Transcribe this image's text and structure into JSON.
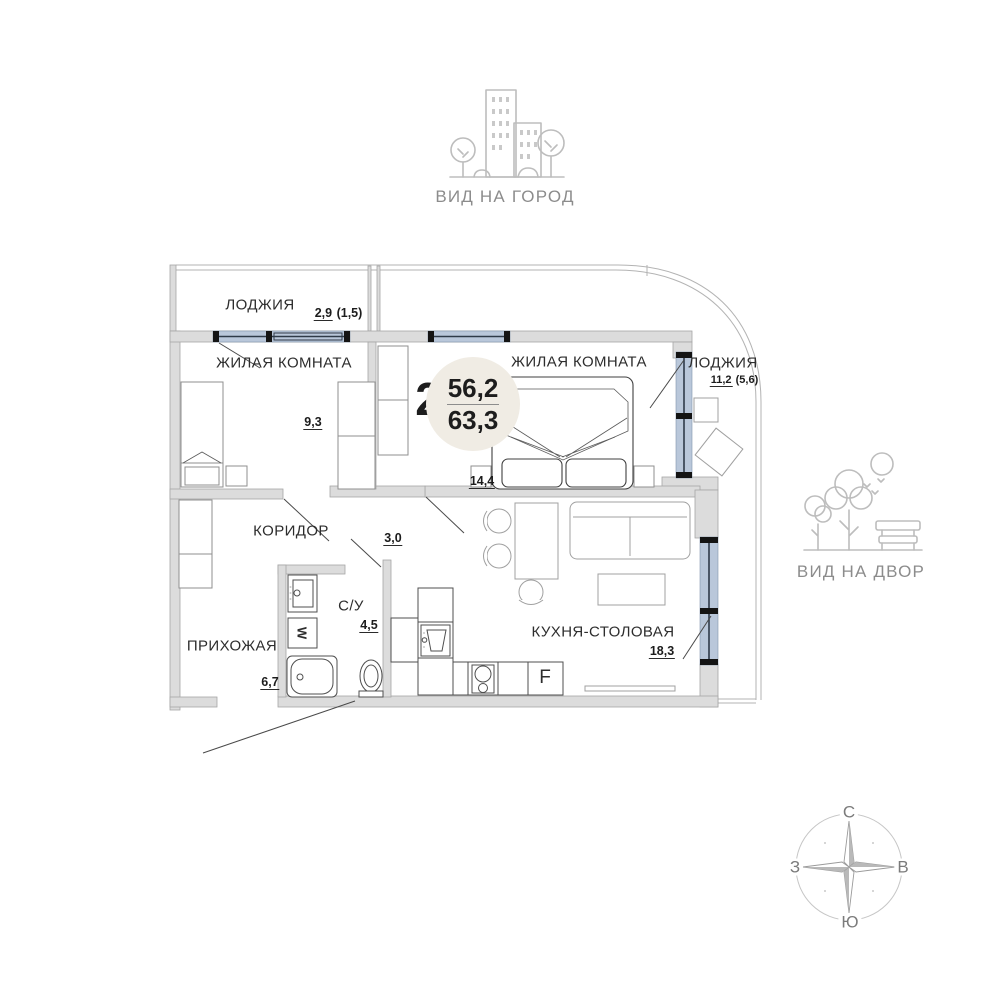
{
  "views": {
    "city_label": "ВИД НА ГОРОД",
    "yard_label": "ВИД НА ДВОР"
  },
  "unit_badge": {
    "rooms": "2",
    "area_living": "56,2",
    "area_total": "63,3"
  },
  "rooms": {
    "loggia_top": {
      "name": "ЛОДЖИЯ",
      "area": "2,9",
      "area_alt": "(1,5)"
    },
    "living1": {
      "name": "ЖИЛАЯ КОМНАТА",
      "area": "9,3",
      "area_alt": ""
    },
    "living2": {
      "name": "ЖИЛАЯ КОМНАТА",
      "area": "14,4",
      "area_alt": ""
    },
    "loggia_right": {
      "name": "ЛОДЖИЯ",
      "area": "11,2",
      "area_alt": "(5,6)"
    },
    "corridor": {
      "name": "КОРИДОР",
      "area": "3,0",
      "area_alt": ""
    },
    "hallway": {
      "name": "ПРИХОЖАЯ",
      "area": "6,7",
      "area_alt": ""
    },
    "bathroom": {
      "name": "С/У",
      "area": "4,5",
      "area_alt": ""
    },
    "kitchen": {
      "name": "КУХНЯ-СТОЛОВАЯ",
      "area": "18,3",
      "area_alt": ""
    }
  },
  "appliances": {
    "fridge": "F",
    "washer": "W"
  },
  "compass": {
    "n": "С",
    "e": "В",
    "s": "Ю",
    "w": "З"
  },
  "colors": {
    "wall": "#dcdcdc",
    "window_glass": "#b9c7da",
    "badge_circle": "#f0ece4",
    "icon_stroke": "#bdbdbd"
  }
}
